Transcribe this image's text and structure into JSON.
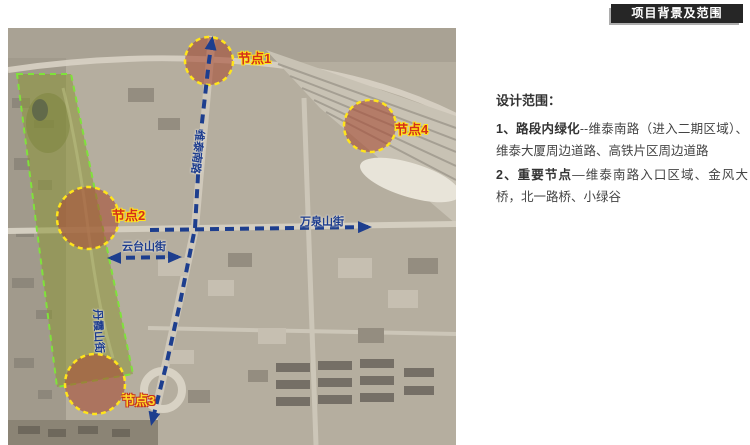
{
  "header": {
    "title": "项目背景及范围"
  },
  "scope": {
    "heading": "设计范围：",
    "items": [
      {
        "bold": "1、路段内绿化",
        "text": "--维泰南路（进入二期区域）、维泰大厦周边道路、高铁片区周边道路"
      },
      {
        "bold": "2、重要节点",
        "text": "—维泰南路入口区域、金风大桥，北一路桥、小绿谷"
      }
    ]
  },
  "map": {
    "nodes": [
      {
        "label": "节点1"
      },
      {
        "label": "节点2"
      },
      {
        "label": "节点3"
      },
      {
        "label": "节点4"
      }
    ],
    "roads": {
      "main_vertical": "维泰南路",
      "horizontal": "万泉山街",
      "diagonal": "云台山街",
      "left_vertical": "丹霞山街"
    },
    "legend_colors": {
      "route_dash_blue": "#1d3e8e",
      "node_circle_stroke": "#ffe41c",
      "node_circle_fill": "#a64d35",
      "park_boundary": "#7fe23b",
      "park_fill": "#8d9537",
      "node_label_red": "#d4301a",
      "header_bg": "#262626"
    }
  }
}
